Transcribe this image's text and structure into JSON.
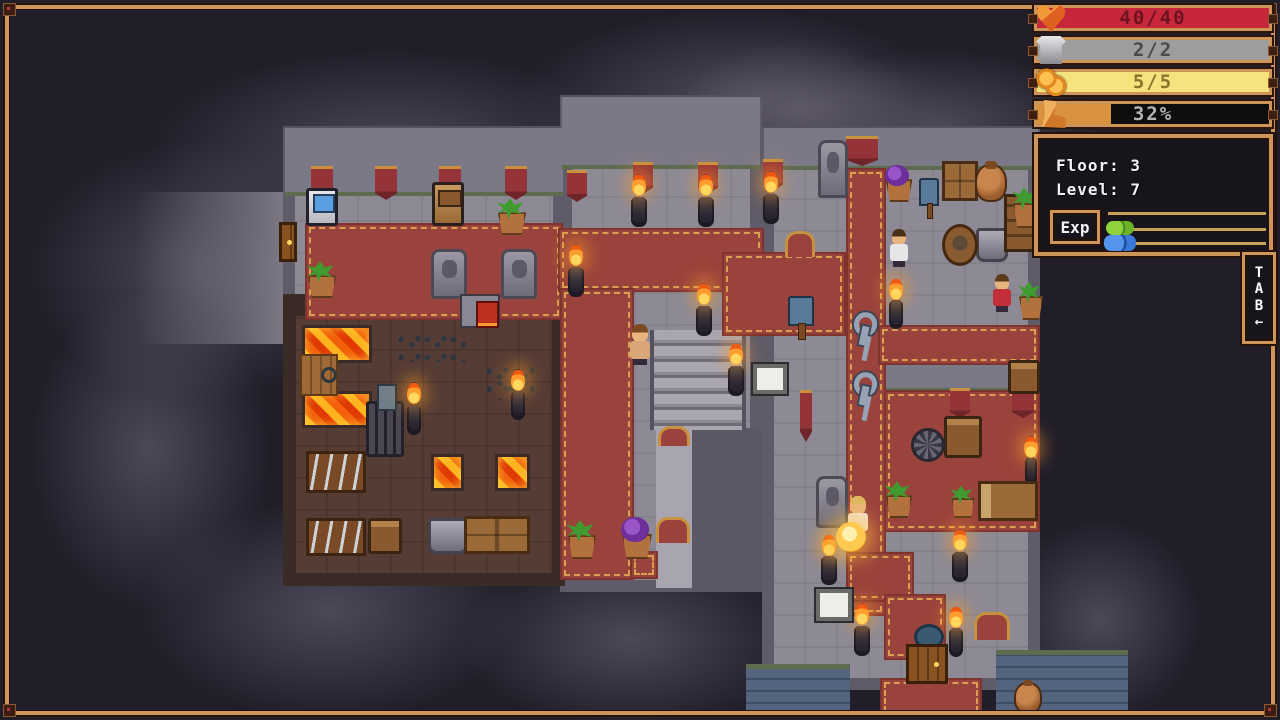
{
  "palette": {
    "background": "#211e2a",
    "frame_wood": "#cf9558",
    "frame_dark": "#241208",
    "stone_floor": "#8d8a96",
    "stone_wall": "#5f5b68",
    "carpet_red": "#9a433c",
    "carpet_gold": "#d9a050",
    "forge_floor": "#553c35",
    "lava_orange": "#f2600a",
    "blue_brick": "#55647e",
    "hud_black": "#17141c",
    "text_white": "#f2f2f2"
  },
  "hud": {
    "bars": [
      {
        "name": "health",
        "icon": "heart",
        "value": "40/40",
        "fill": "#c6273b",
        "fill_pct": 100,
        "empty": "#c6273b",
        "text_color": "#6d1220",
        "top": 3
      },
      {
        "name": "armor",
        "icon": "armor",
        "value": "2/2",
        "fill": "#9d9d9d",
        "fill_pct": 100,
        "empty": "#9d9d9d",
        "text_color": "#4a4a4a",
        "top": 35
      },
      {
        "name": "coins",
        "icon": "coins",
        "value": "5/5",
        "fill": "#f6e37e",
        "fill_pct": 100,
        "empty": "#f6e37e",
        "text_color": "#8a7430",
        "top": 67
      },
      {
        "name": "stamina",
        "icon": "boot",
        "value": "32%",
        "fill": "#d8923f",
        "fill_pct": 32,
        "empty": "#0e0e0e",
        "text_color": "#b5b5b5",
        "top": 99
      }
    ],
    "info": {
      "floor": "Floor: 3",
      "level": "Level: 7",
      "exp_label": "Exp"
    },
    "tab": {
      "letters": [
        "T",
        "A",
        "B"
      ],
      "arrow": "←"
    }
  },
  "map": {
    "layers": [
      {
        "cls": "fog",
        "name": "fog-patch",
        "items": [
          {
            "x": 30,
            "y": 140,
            "w": 340,
            "h": 260
          },
          {
            "x": 150,
            "y": 50,
            "w": 480,
            "h": 200
          },
          {
            "x": 520,
            "y": 10,
            "w": 430,
            "h": 180
          },
          {
            "x": 780,
            "y": 50,
            "w": 320,
            "h": 150
          },
          {
            "x": 30,
            "y": 290,
            "w": 240,
            "h": 320
          },
          {
            "x": 140,
            "y": 500,
            "w": 380,
            "h": 220
          },
          {
            "x": 460,
            "y": 550,
            "w": 340,
            "h": 180
          },
          {
            "x": 1000,
            "y": 520,
            "w": 200,
            "h": 200
          },
          {
            "x": 680,
            "y": 40,
            "w": 240,
            "h": 140
          }
        ]
      },
      {
        "cls": "stonefade",
        "name": "dark-corridor",
        "items": [
          {
            "x": 135,
            "y": 192,
            "w": 170,
            "h": 152
          }
        ]
      },
      {
        "cls": "stone",
        "name": "stone-floor",
        "items": [
          {
            "x": 283,
            "y": 126,
            "w": 282,
            "h": 202
          },
          {
            "x": 560,
            "y": 95,
            "w": 202,
            "h": 497
          },
          {
            "x": 762,
            "y": 126,
            "w": 278,
            "h": 564
          }
        ]
      },
      {
        "cls": "wall",
        "name": "wall-band",
        "items": [
          {
            "x": 285,
            "y": 128,
            "w": 278,
            "h": 68
          },
          {
            "x": 562,
            "y": 97,
            "w": 198,
            "h": 72
          },
          {
            "x": 764,
            "y": 128,
            "w": 274,
            "h": 42
          },
          {
            "x": 884,
            "y": 358,
            "w": 156,
            "h": 34
          }
        ]
      },
      {
        "cls": "walldark",
        "name": "inner-wall",
        "items": [
          {
            "x": 692,
            "y": 428,
            "w": 70,
            "h": 164
          }
        ]
      },
      {
        "cls": "lightpath",
        "name": "stair-corridor",
        "items": [
          {
            "x": 656,
            "y": 428,
            "w": 36,
            "h": 160
          }
        ]
      },
      {
        "cls": "stairs",
        "name": "stairs",
        "items": [
          {
            "x": 650,
            "y": 330,
            "w": 96,
            "h": 100
          }
        ]
      },
      {
        "cls": "brownroom",
        "name": "forge-room",
        "items": [
          {
            "x": 283,
            "y": 294,
            "w": 282,
            "h": 292
          }
        ]
      },
      {
        "cls": "bluebrick",
        "name": "blue-brick-floor",
        "items": [
          {
            "x": 746,
            "y": 664,
            "w": 104,
            "h": 50
          },
          {
            "x": 996,
            "y": 650,
            "w": 132,
            "h": 64
          }
        ]
      },
      {
        "cls": "carpet",
        "name": "carpet-path",
        "items": [
          {
            "x": 305,
            "y": 223,
            "w": 258,
            "h": 97
          },
          {
            "x": 558,
            "y": 228,
            "w": 206,
            "h": 64
          },
          {
            "x": 560,
            "y": 288,
            "w": 74,
            "h": 292
          },
          {
            "x": 630,
            "y": 551,
            "w": 28,
            "h": 28
          },
          {
            "x": 722,
            "y": 252,
            "w": 124,
            "h": 84
          },
          {
            "x": 846,
            "y": 168,
            "w": 40,
            "h": 448
          },
          {
            "x": 878,
            "y": 325,
            "w": 162,
            "h": 40
          },
          {
            "x": 884,
            "y": 390,
            "w": 156,
            "h": 142
          },
          {
            "x": 846,
            "y": 552,
            "w": 68,
            "h": 50
          },
          {
            "x": 884,
            "y": 594,
            "w": 62,
            "h": 66
          },
          {
            "x": 880,
            "y": 678,
            "w": 102,
            "h": 38
          }
        ]
      },
      {
        "cls": "lava",
        "name": "lava-pool",
        "items": [
          {
            "x": 302,
            "y": 325,
            "w": 70,
            "h": 38
          },
          {
            "x": 302,
            "y": 391,
            "w": 70,
            "h": 37
          },
          {
            "x": 431,
            "y": 454,
            "w": 33,
            "h": 37
          },
          {
            "x": 495,
            "y": 454,
            "w": 35,
            "h": 37
          }
        ]
      }
    ],
    "objects": [
      {
        "t": "banner",
        "x": 311,
        "y": 166,
        "w": 22,
        "h": 34
      },
      {
        "t": "banner",
        "x": 375,
        "y": 166,
        "w": 22,
        "h": 34
      },
      {
        "t": "banner",
        "x": 439,
        "y": 166,
        "w": 22,
        "h": 34
      },
      {
        "t": "banner",
        "x": 505,
        "y": 166,
        "w": 22,
        "h": 34
      },
      {
        "t": "banner",
        "x": 567,
        "y": 170,
        "w": 20,
        "h": 32
      },
      {
        "t": "banner",
        "x": 633,
        "y": 162,
        "w": 20,
        "h": 32
      },
      {
        "t": "banner",
        "x": 698,
        "y": 162,
        "w": 20,
        "h": 32
      },
      {
        "t": "banner",
        "x": 763,
        "y": 159,
        "w": 20,
        "h": 32
      },
      {
        "t": "banner",
        "x": 846,
        "y": 136,
        "w": 32,
        "h": 30
      },
      {
        "t": "banner",
        "x": 950,
        "y": 388,
        "w": 20,
        "h": 30
      },
      {
        "t": "banner",
        "x": 1012,
        "y": 388,
        "w": 22,
        "h": 30
      },
      {
        "t": "banner",
        "x": 800,
        "y": 390,
        "w": 12,
        "h": 52
      },
      {
        "t": "mat",
        "x": 785,
        "y": 231,
        "w": 30,
        "h": 26
      },
      {
        "t": "mat",
        "x": 658,
        "y": 426,
        "w": 32,
        "h": 20
      },
      {
        "t": "mat",
        "x": 656,
        "y": 517,
        "w": 34,
        "h": 26
      },
      {
        "t": "statue",
        "x": 431,
        "y": 249,
        "w": 36,
        "h": 50
      },
      {
        "t": "statue",
        "x": 501,
        "y": 249,
        "w": 36,
        "h": 50
      },
      {
        "t": "statue",
        "x": 818,
        "y": 140,
        "w": 30,
        "h": 58
      },
      {
        "t": "statue",
        "x": 816,
        "y": 476,
        "w": 32,
        "h": 52
      },
      {
        "t": "vend",
        "x": 306,
        "y": 188,
        "w": 32,
        "h": 38
      },
      {
        "t": "mach",
        "x": 432,
        "y": 182,
        "w": 32,
        "h": 44
      },
      {
        "t": "forge",
        "x": 460,
        "y": 294,
        "w": 40,
        "h": 34
      },
      {
        "t": "furnace",
        "x": 366,
        "y": 401,
        "w": 38,
        "h": 56
      },
      {
        "t": "wood",
        "x": 300,
        "y": 354,
        "w": 38,
        "h": 42
      },
      {
        "t": "rack",
        "x": 306,
        "y": 451,
        "w": 60,
        "h": 42
      },
      {
        "t": "rack",
        "x": 306,
        "y": 518,
        "w": 60,
        "h": 38
      },
      {
        "t": "chest",
        "x": 368,
        "y": 518,
        "w": 34,
        "h": 36
      },
      {
        "t": "chest",
        "x": 944,
        "y": 416,
        "w": 38,
        "h": 42
      },
      {
        "t": "chest",
        "x": 1008,
        "y": 360,
        "w": 32,
        "h": 34
      },
      {
        "t": "anvil",
        "x": 428,
        "y": 518,
        "w": 40,
        "h": 36
      },
      {
        "t": "anvil",
        "x": 976,
        "y": 228,
        "w": 32,
        "h": 34
      },
      {
        "t": "crate",
        "x": 464,
        "y": 516,
        "w": 66,
        "h": 38
      },
      {
        "t": "crate",
        "x": 942,
        "y": 161,
        "w": 36,
        "h": 40
      },
      {
        "t": "amph",
        "x": 975,
        "y": 164,
        "w": 32,
        "h": 38
      },
      {
        "t": "amph",
        "x": 1014,
        "y": 682,
        "w": 28,
        "h": 32
      },
      {
        "t": "barrel",
        "x": 942,
        "y": 224,
        "w": 36,
        "h": 42
      },
      {
        "t": "shelf",
        "x": 1004,
        "y": 194,
        "w": 36,
        "h": 58
      },
      {
        "t": "calt",
        "x": 396,
        "y": 334,
        "w": 70,
        "h": 28
      },
      {
        "t": "calt",
        "x": 484,
        "y": 366,
        "w": 50,
        "h": 26
      },
      {
        "t": "calt",
        "x": 495,
        "y": 378,
        "w": 34,
        "h": 22
      },
      {
        "t": "plant",
        "x": 494,
        "y": 201,
        "w": 32,
        "h": 34
      },
      {
        "t": "plant",
        "x": 304,
        "y": 264,
        "w": 32,
        "h": 34
      },
      {
        "t": "plant",
        "x": 1010,
        "y": 190,
        "w": 28,
        "h": 38
      },
      {
        "t": "plant",
        "x": 1016,
        "y": 284,
        "w": 26,
        "h": 36
      },
      {
        "t": "plant",
        "x": 564,
        "y": 523,
        "w": 32,
        "h": 36
      },
      {
        "t": "plant",
        "x": 882,
        "y": 484,
        "w": 30,
        "h": 34
      },
      {
        "t": "plant",
        "x": 948,
        "y": 488,
        "w": 26,
        "h": 30
      },
      {
        "t": "plantp",
        "x": 882,
        "y": 168,
        "w": 30,
        "h": 34
      },
      {
        "t": "plantp",
        "x": 618,
        "y": 521,
        "w": 34,
        "h": 38
      },
      {
        "t": "torch",
        "x": 628,
        "y": 176,
        "w": 22,
        "h": 46
      },
      {
        "t": "torch",
        "x": 695,
        "y": 176,
        "w": 22,
        "h": 46
      },
      {
        "t": "torch",
        "x": 760,
        "y": 173,
        "w": 22,
        "h": 46
      },
      {
        "t": "torch",
        "x": 565,
        "y": 246,
        "w": 22,
        "h": 46
      },
      {
        "t": "torch",
        "x": 693,
        "y": 285,
        "w": 22,
        "h": 46
      },
      {
        "t": "torch",
        "x": 725,
        "y": 345,
        "w": 22,
        "h": 46
      },
      {
        "t": "torch",
        "x": 886,
        "y": 280,
        "w": 20,
        "h": 44
      },
      {
        "t": "torch",
        "x": 404,
        "y": 384,
        "w": 20,
        "h": 46
      },
      {
        "t": "torch",
        "x": 509,
        "y": 371,
        "w": 18,
        "h": 44
      },
      {
        "t": "torch",
        "x": 818,
        "y": 536,
        "w": 22,
        "h": 44
      },
      {
        "t": "torch",
        "x": 949,
        "y": 531,
        "w": 22,
        "h": 46
      },
      {
        "t": "torch",
        "x": 851,
        "y": 605,
        "w": 22,
        "h": 46
      },
      {
        "t": "torch",
        "x": 946,
        "y": 608,
        "w": 20,
        "h": 44
      },
      {
        "t": "torch",
        "x": 1023,
        "y": 438,
        "w": 16,
        "h": 42
      },
      {
        "t": "key",
        "x": 849,
        "y": 311,
        "w": 30,
        "h": 36
      },
      {
        "t": "key",
        "x": 849,
        "y": 371,
        "w": 30,
        "h": 36
      },
      {
        "t": "wheel",
        "x": 911,
        "y": 428,
        "w": 34,
        "h": 34
      },
      {
        "t": "bed",
        "x": 978,
        "y": 481,
        "w": 60,
        "h": 40
      },
      {
        "t": "bench",
        "x": 974,
        "y": 612,
        "w": 36,
        "h": 28
      },
      {
        "t": "tablet",
        "x": 753,
        "y": 364,
        "w": 34,
        "h": 30
      },
      {
        "t": "tablet",
        "x": 816,
        "y": 589,
        "w": 36,
        "h": 32
      },
      {
        "t": "sign",
        "x": 788,
        "y": 296,
        "w": 26,
        "h": 30
      },
      {
        "t": "sign",
        "x": 919,
        "y": 178,
        "w": 20,
        "h": 28
      },
      {
        "t": "signflat",
        "x": 914,
        "y": 624,
        "w": 30,
        "h": 26
      },
      {
        "t": "door",
        "x": 906,
        "y": 644,
        "w": 42,
        "h": 40
      },
      {
        "t": "door",
        "x": 279,
        "y": 222,
        "w": 18,
        "h": 40
      },
      {
        "t": "npc",
        "v": "player",
        "x": 626,
        "y": 324,
        "w": 28,
        "h": 44
      },
      {
        "t": "npc",
        "v": "man",
        "x": 886,
        "y": 229,
        "w": 26,
        "h": 40
      },
      {
        "t": "npc",
        "v": "woman",
        "x": 989,
        "y": 274,
        "w": 26,
        "h": 40
      },
      {
        "t": "npc",
        "v": "girl",
        "x": 844,
        "y": 496,
        "w": 28,
        "h": 44
      },
      {
        "t": "orb",
        "x": 836,
        "y": 522,
        "w": 30,
        "h": 30
      }
    ]
  }
}
